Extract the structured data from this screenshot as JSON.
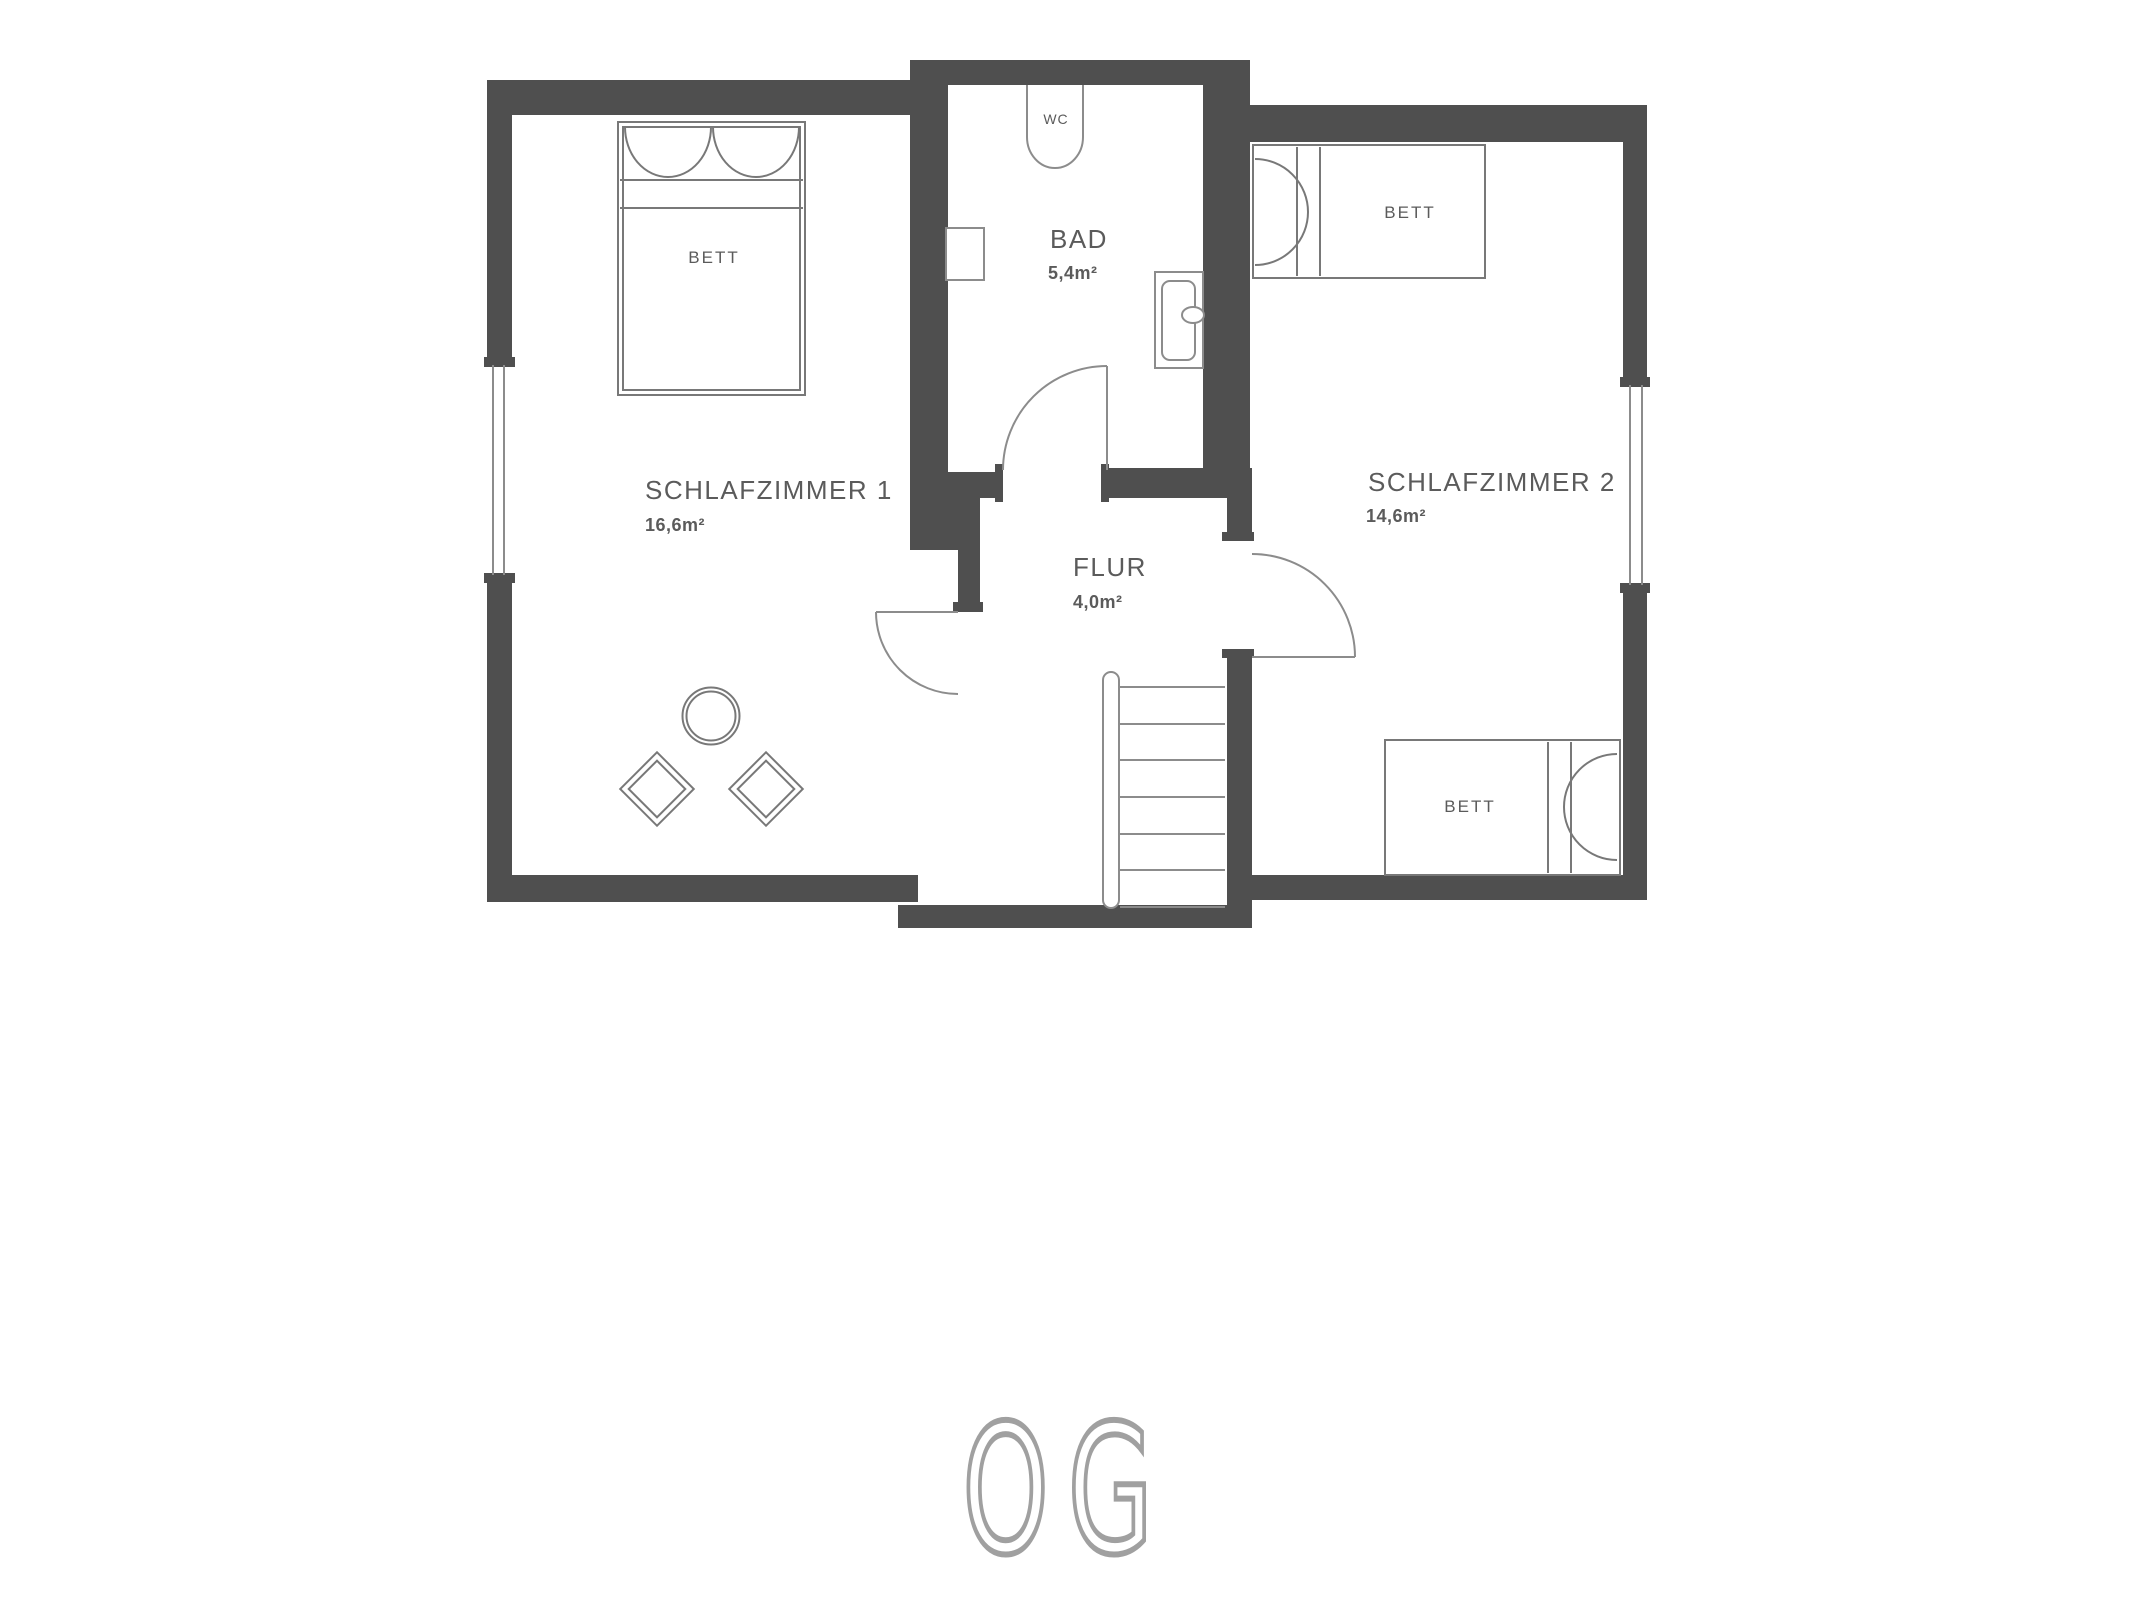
{
  "floorplan": {
    "title_floor": "OG",
    "rooms": {
      "schlafzimmer1": {
        "name": "SCHLAFZIMMER 1",
        "area": "16,6m²"
      },
      "bad": {
        "name": "BAD",
        "area": "5,4m²"
      },
      "flur": {
        "name": "FLUR",
        "area": "4,0m²"
      },
      "schlafzimmer2": {
        "name": "SCHLAFZIMMER 2",
        "area": "14,6m²"
      }
    },
    "labels": {
      "bed": "BETT",
      "wc": "WC"
    }
  },
  "colors": {
    "wall": "#4f4f4f",
    "furniture_line": "#8c8c8c",
    "bed_line": "#787878",
    "text": "#5b5b5b",
    "floor_label": "#a0a0a0",
    "background": "#ffffff"
  }
}
